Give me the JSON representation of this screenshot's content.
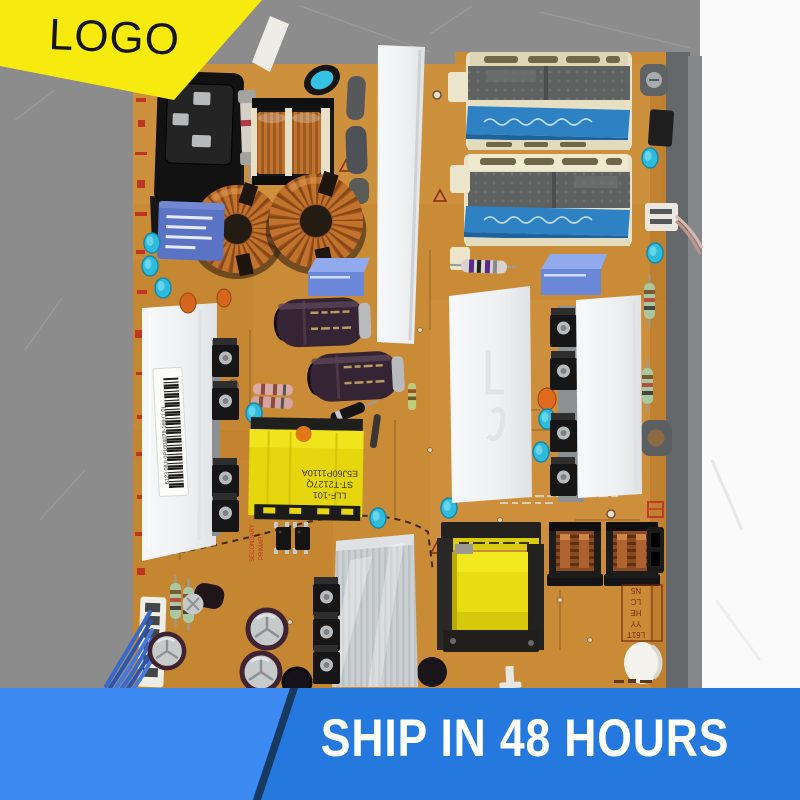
{
  "logo_banner": {
    "label": "LOGO",
    "bg_color": "#f7ea0e",
    "text_color": "#141414"
  },
  "ship_banner": {
    "label": "SHIP IN 48 HOURS",
    "bg_left": "#3d8bf2",
    "bg_right": "#2478de",
    "divider_color": "#18395f",
    "text_color": "#ffffff"
  },
  "photo": {
    "background_left_color": "#8b8c8b",
    "background_right_color": "#fafafa",
    "board_color": "#c98b36",
    "labels": {
      "barcode_text": "6123 08JL0P1004078-169 (1.0)",
      "silkscreen_secondary": "SECONDARY",
      "silkscreen_primary": "PRIMARY",
      "transformer_line1": "LLF-101",
      "transformer_line2": "ST-T2127Q",
      "transformer_line3": "E5J60P1110A",
      "id_box": [
        "N5",
        "LC",
        "HE",
        "YY",
        "L61T"
      ]
    }
  }
}
